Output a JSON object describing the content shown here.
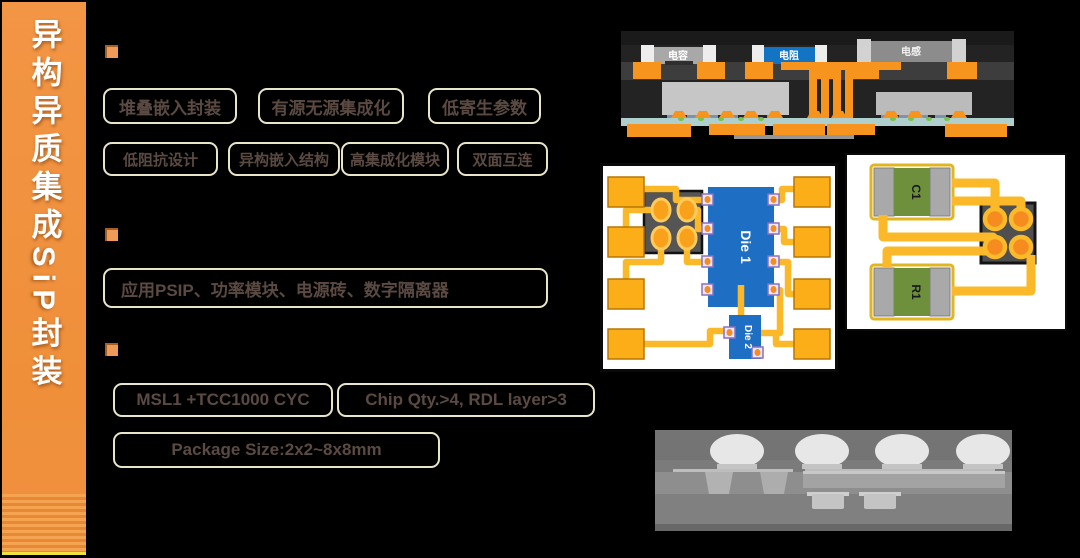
{
  "slide": {
    "title": "异构异质集成SiP封装"
  },
  "features": {
    "row1": [
      "堆叠嵌入封装",
      "有源无源集成化",
      "低寄生参数"
    ],
    "row2": [
      "低阻抗设计",
      "异构嵌入结构",
      "高集成化模块",
      "双面互连"
    ]
  },
  "application": {
    "text": "应用PSIP、功率模块、电源砖、数字隔离器"
  },
  "specs": {
    "reliability": "MSL1 +TCC1000 CYC",
    "chip": "Chip Qty.>4, RDL layer>3",
    "package": "Package Size:2x2~8x8mm"
  },
  "diagrams": {
    "cross_section": {
      "capacitor_label": "电容",
      "resistor_label": "电阻",
      "inductor_label": "电感"
    },
    "rdl_layout": {
      "die1_label": "Die 1",
      "die2_label": "Die 2"
    },
    "component_layout": {
      "c1_label": "C1",
      "r1_label": "R1"
    }
  },
  "colors": {
    "sidebar_orange": "#F0923F",
    "box_border": "#E9E5C8",
    "box_text": "#5B4A42",
    "trace_yellow": "#FBB829",
    "pad_orange": "#F7941D",
    "die_blue": "#1E6FC4",
    "resistor_blue": "#1474C4",
    "component_green": "#6E8F3C",
    "substrate_teal": "#AFCFCF"
  }
}
